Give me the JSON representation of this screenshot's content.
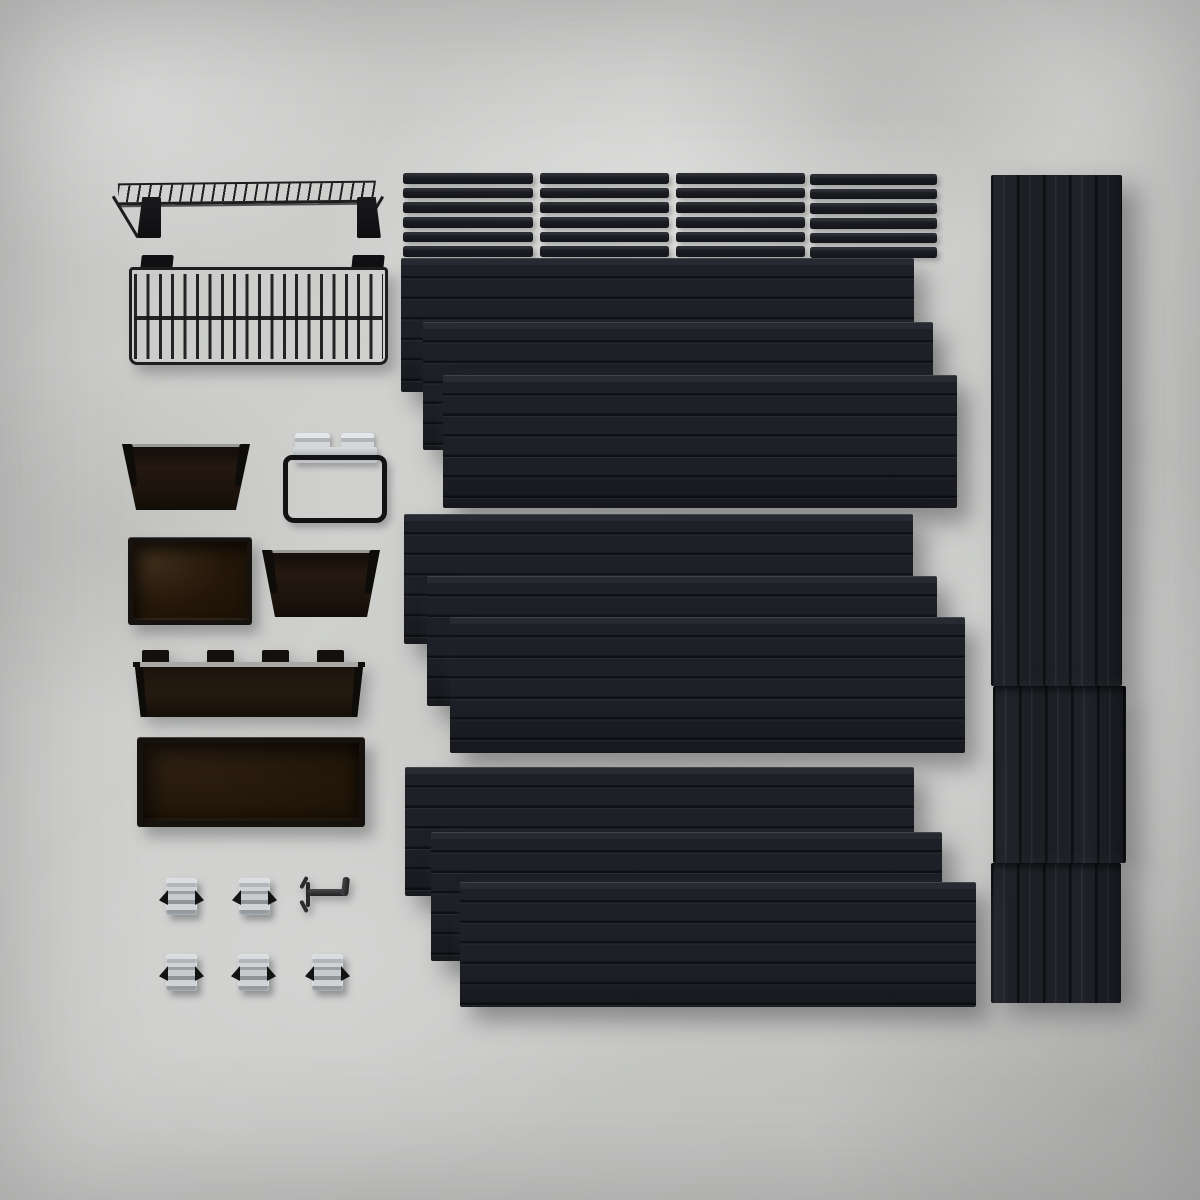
{
  "image": {
    "type": "product-photo-flatlay",
    "subject": "Black slatwall garage wall-organization kit parts arranged on a gray concrete surface, viewed from above",
    "visible_text": "none"
  },
  "colors": {
    "bg-base": "#c8c9c7",
    "panel-face": "#1d2026",
    "panel-top": "#272b31",
    "panel-dark": "#17191e",
    "wire": "#1d1d1f",
    "bin-brown": "#241810",
    "bin-brown-light": "#3c2c1a",
    "rim-silver": "#a8a8a6",
    "clip-silver-light": "#d8dcdf",
    "clip-silver-dark": "#8f9498",
    "prong": "#131313"
  },
  "counts": {
    "strip_groups": 4,
    "strips_per_group": 6,
    "panel_stacks": 3,
    "panels_per_stack": 3,
    "vertical_rail_segments": 3,
    "spring_clips": 5,
    "single_hooks": 1,
    "bins": 5
  },
  "items": [
    {
      "label": "Wire wall shelf with two brackets",
      "qty": 1
    },
    {
      "label": "Wire storage basket with mounting tabs",
      "qty": 1
    },
    {
      "label": "Slat trim strips, 4 bundles of 6",
      "qty": 24
    },
    {
      "label": "Large black slatwall panels, 3 fanned stacks of 3",
      "qty": 9
    },
    {
      "label": "Vertical slat panel stack (right side)",
      "qty": 3
    },
    {
      "label": "Small tapered translucent brown bin",
      "qty": 2
    },
    {
      "label": "Square translucent brown bin",
      "qty": 1
    },
    {
      "label": "Wide shallow brown bin with mounting tabs",
      "qty": 1
    },
    {
      "label": "Large open brown storage bin",
      "qty": 1
    },
    {
      "label": "Wire loop holder with two silver clips",
      "qty": 1
    },
    {
      "label": "Silver spring-clip tool hooks",
      "qty": 5
    },
    {
      "label": "Single black wall hook with clip",
      "qty": 1
    }
  ]
}
